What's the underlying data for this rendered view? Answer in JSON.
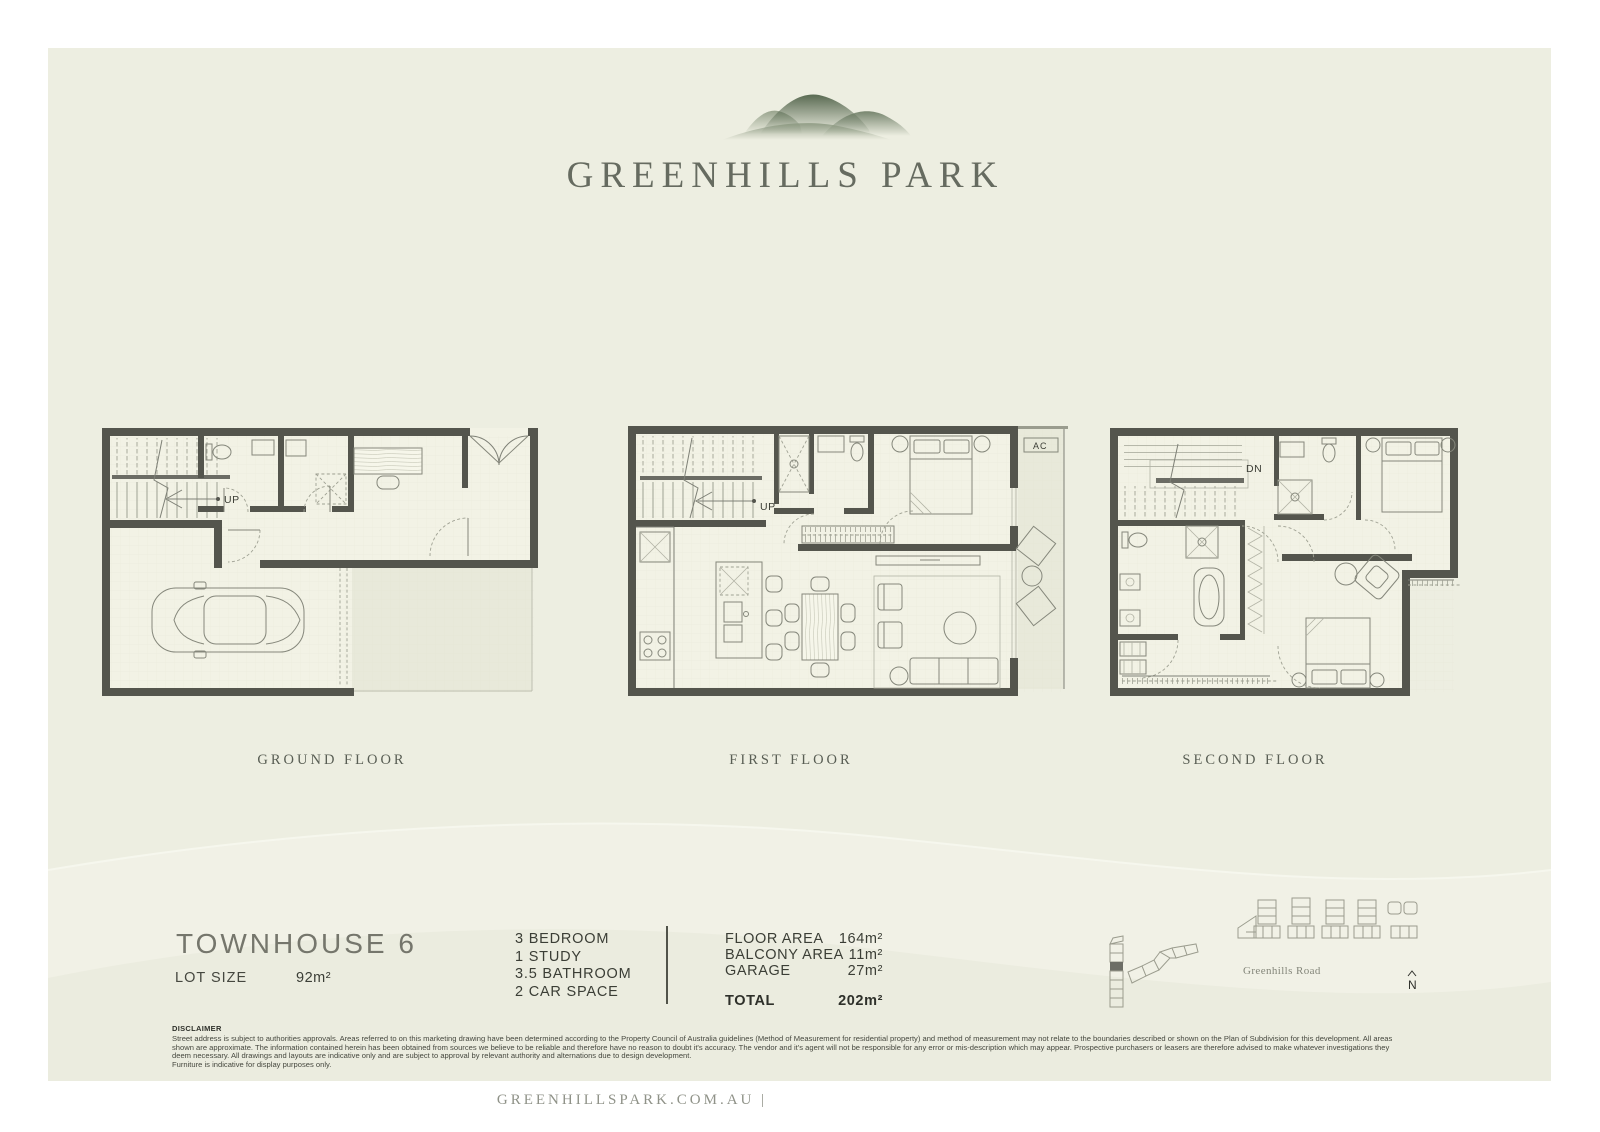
{
  "logo": {
    "title": "GREENHILLS PARK"
  },
  "plans": {
    "ground": {
      "label": "GROUND FLOOR",
      "annotation": "UP"
    },
    "first": {
      "label": "FIRST FLOOR",
      "annotation": "UP",
      "ac": "AC"
    },
    "second": {
      "label": "SECOND FLOOR",
      "annotation": "DN"
    }
  },
  "summary": {
    "title": "TOWNHOUSE 6",
    "lot_size_label": "LOT SIZE",
    "lot_size_value": "92m²",
    "features": [
      "3 BEDROOM",
      "1 STUDY",
      "3.5 BATHROOM",
      "2 CAR SPACE"
    ],
    "areas": [
      {
        "label": "FLOOR AREA",
        "value": "164m²"
      },
      {
        "label": "BALCONY AREA",
        "value": "11m²"
      },
      {
        "label": "GARAGE",
        "value": "27m²"
      }
    ],
    "total": {
      "label": "TOTAL",
      "value": "202m²"
    }
  },
  "site_plan": {
    "road": "Greenhills Road",
    "north": "N"
  },
  "disclaimer": {
    "heading": "DISCLAIMER",
    "body": "Street address is subject to authorities approvals. Areas referred to on this marketing drawing have been determined according to the Property Council of Australia guidelines (Method of Measurement for residential property) and method of measurement may not relate to the boundaries described or shown on the Plan of Subdivision for this development. All areas shown are approximate. The information contained herein has been obtained from sources we believe to be reliable and therefore have no reason to doubt it's accuracy. The vendor and it's agent will not be responsible for any error or mis-description which may appear. Prospective purchasers or leasers are therefore advised to make whatever investigations they deem necessary. All drawings and layouts are indicative only and are subject to approval by relevant authority and alternations due to design development.",
    "note": "Furniture is indicative for display purposes only."
  },
  "footer": {
    "website": "GREENHILLSPARK.COM.AU |"
  },
  "colors": {
    "page_background": "#ffffff",
    "canvas_background": "#edeee1",
    "wall": "#54554d",
    "logo_green": "#5a6b52",
    "text_dark": "#3b3e36",
    "text_muted": "#75766c"
  }
}
